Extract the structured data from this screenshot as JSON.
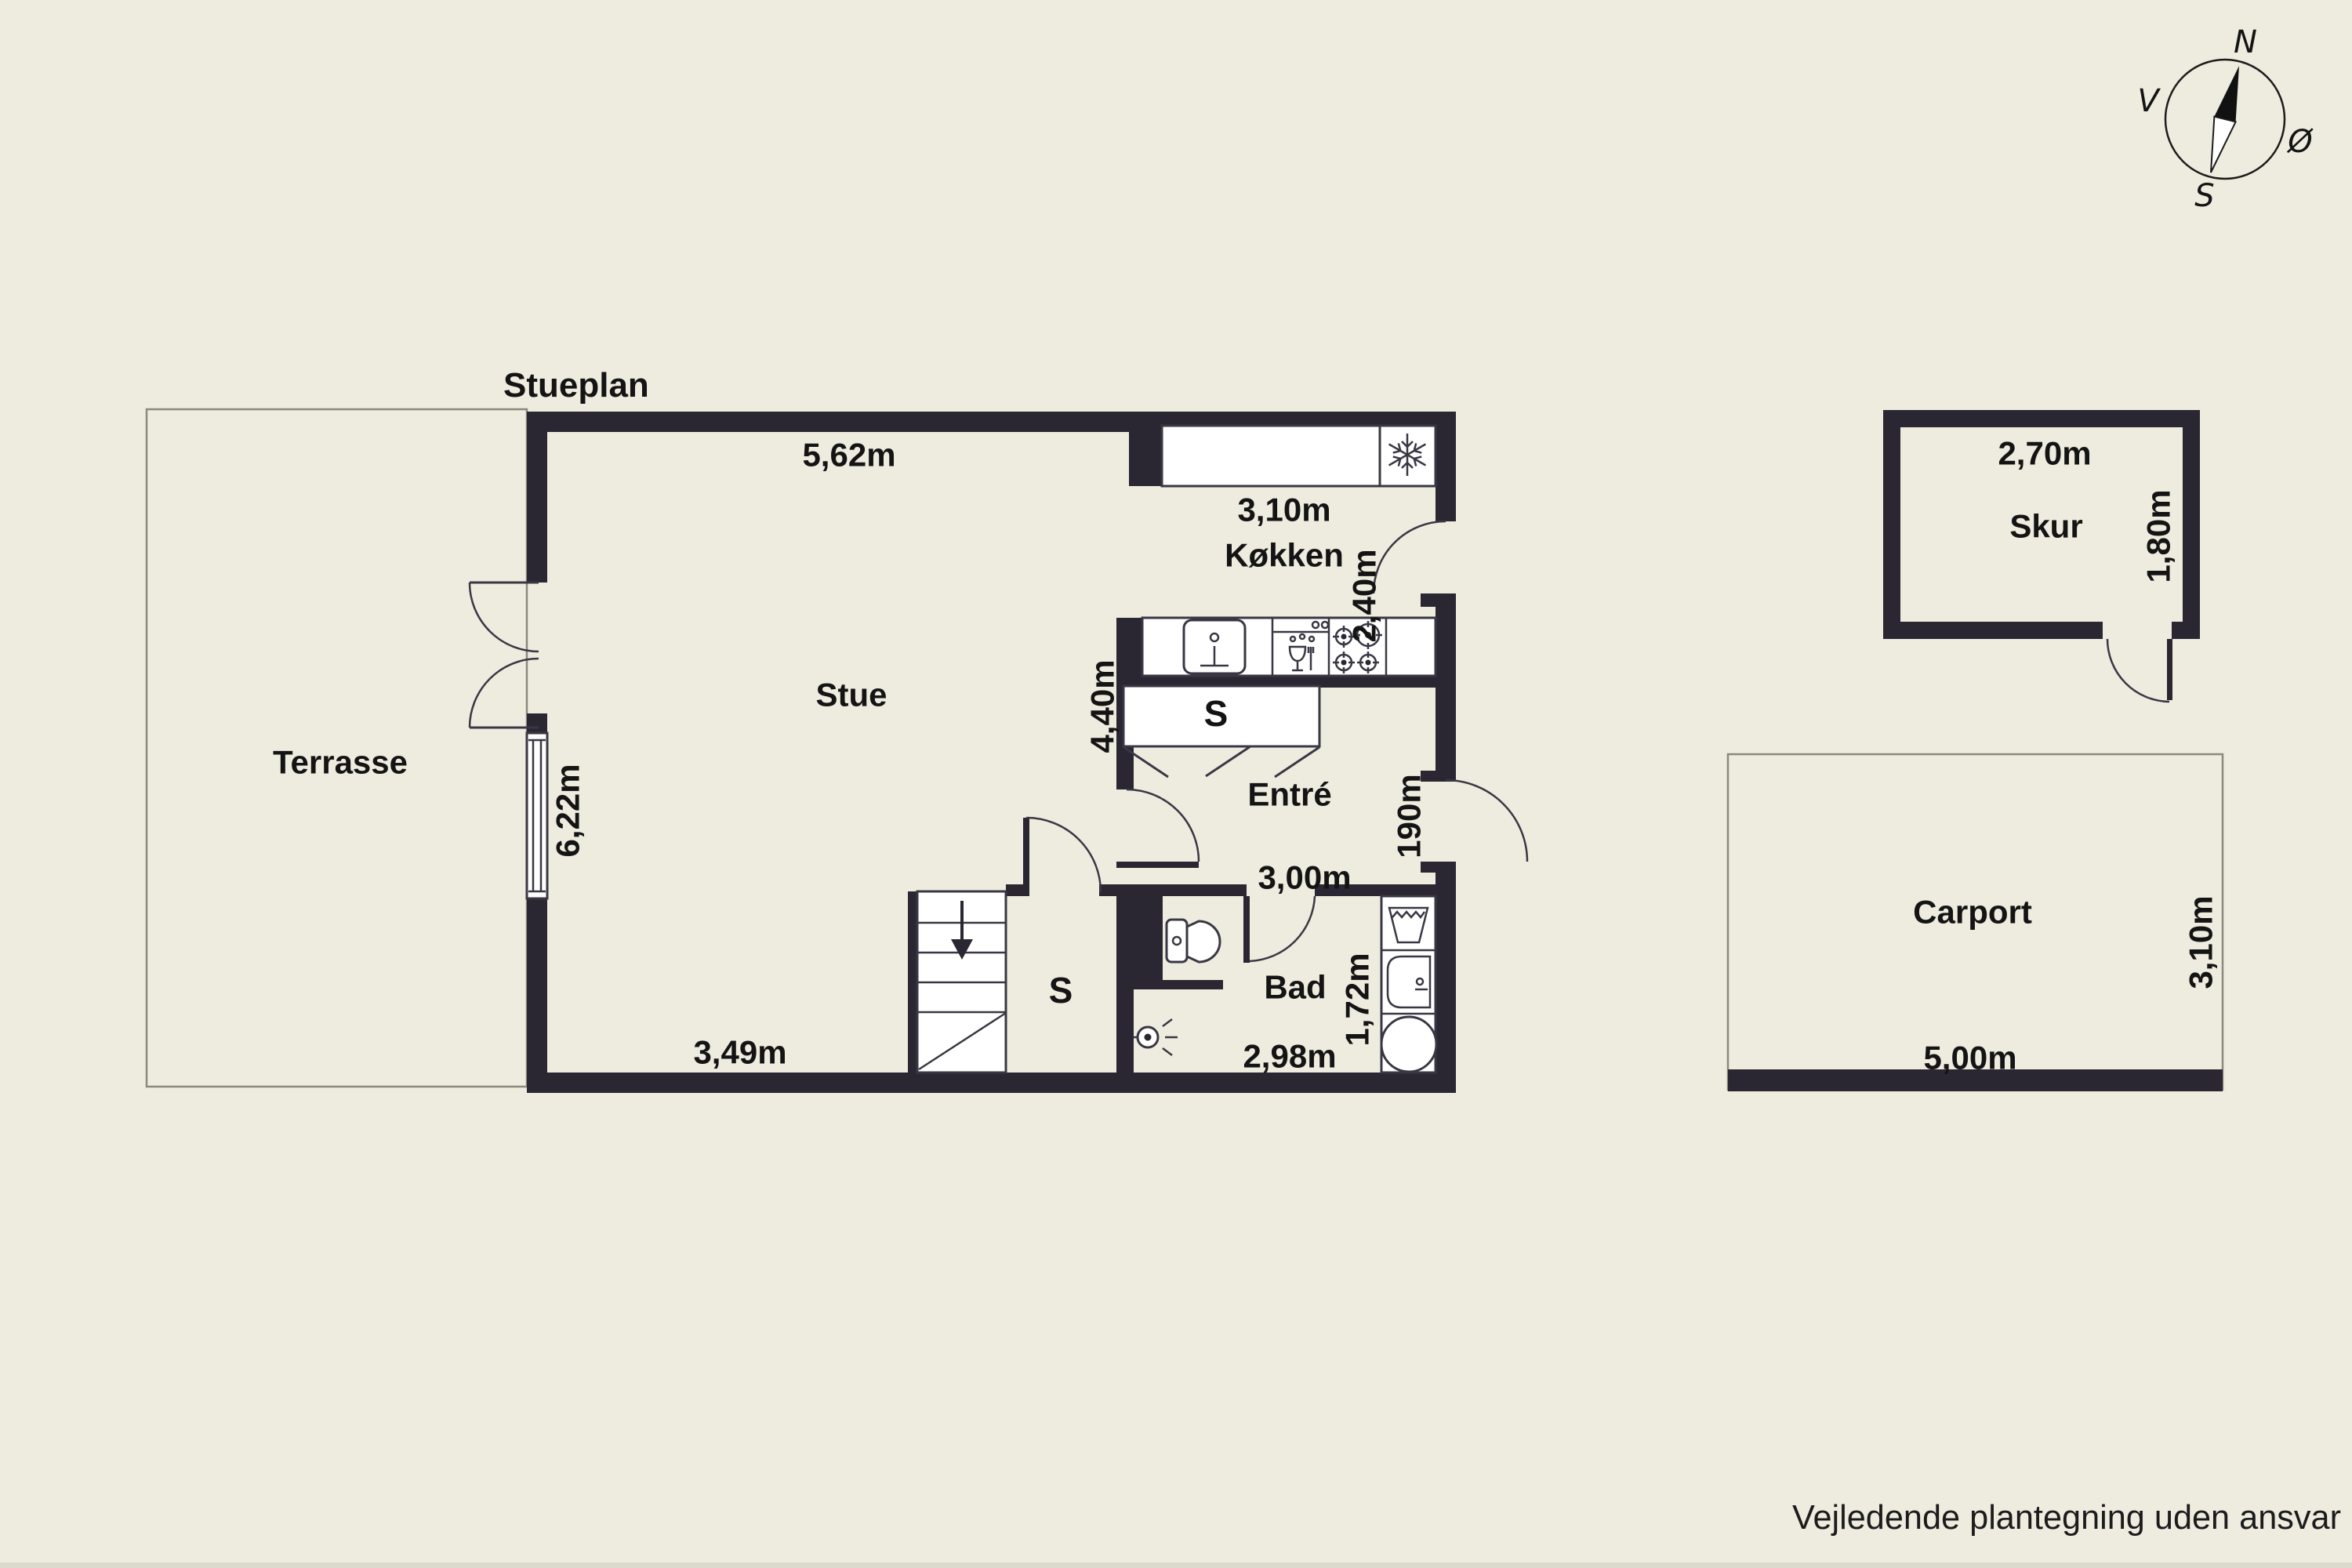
{
  "page": {
    "title": "Stueplan",
    "disclaimer": "Vejledende plantegning uden ansvar"
  },
  "compass": {
    "north": "N",
    "west": "V",
    "east": "Ø",
    "south": "S"
  },
  "colors": {
    "background": "#eeecdf",
    "wall": "#2a2732",
    "line": "#3a3744",
    "fixture_fill": "#ffffff",
    "thin_outline": "#8b897d",
    "text": "#141414"
  },
  "rooms": {
    "terrasse": {
      "label": "Terrasse"
    },
    "stue": {
      "label": "Stue",
      "measure_top": "5,62m",
      "measure_left": "6,22m",
      "measure_bottom": "3,49m"
    },
    "koekken": {
      "label": "Køkken",
      "measure_width": "3,10m",
      "measure_depth": "2,40m"
    },
    "entre": {
      "label": "Entré",
      "measure_width": "3,00m",
      "measure_left_wall": "4,40m",
      "measure_door_wall": "190m"
    },
    "closet_entre": {
      "label": "S"
    },
    "closet_stairs": {
      "label": "S"
    },
    "bad": {
      "label": "Bad",
      "measure_width": "2,98m",
      "measure_depth": "1,72m"
    },
    "skur": {
      "label": "Skur",
      "measure_width": "2,70m",
      "measure_depth": "1,80m"
    },
    "carport": {
      "label": "Carport",
      "measure_width": "5,00m",
      "measure_depth": "3,10m"
    }
  }
}
